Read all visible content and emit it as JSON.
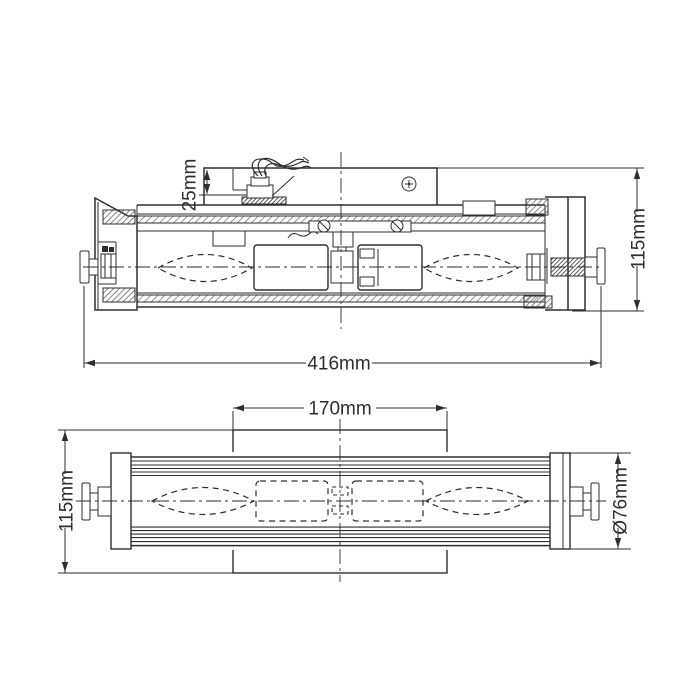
{
  "colors": {
    "line": "#2e2e2e",
    "background": "#ffffff"
  },
  "side_view": {
    "recess_depth": "25mm",
    "overall_height": "115mm",
    "overall_width": "416mm"
  },
  "front_view": {
    "backplate_width": "170mm",
    "overall_height": "115mm",
    "tube_diameter": "Ø76mm"
  }
}
